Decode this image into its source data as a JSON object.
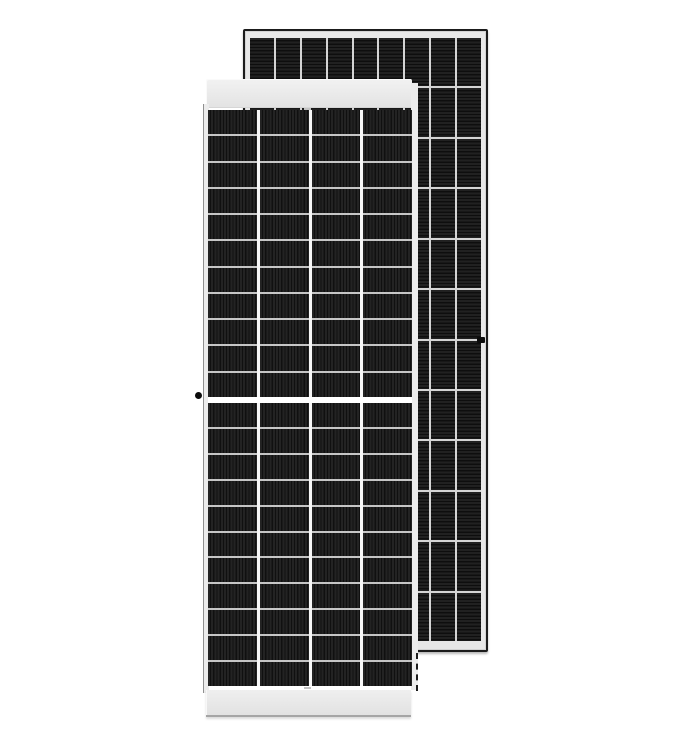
{
  "scene": {
    "type": "product-photo",
    "subject": "Two monocrystalline solar panels: front-view half-cut-cell module overlapping a rear-view module standing behind it",
    "background": "#ffffff"
  },
  "colors": {
    "page_bg": "#ffffff",
    "back_border": "#1b1b1b",
    "back_frame": "#e7e7e7",
    "back_sep": "#d4d4d4",
    "back_cell_a": "#212121",
    "back_cell_b": "#0e0e0e",
    "front_band_top": "#f2f2f2",
    "front_band_bottom": "#e3e3e3",
    "front_frame": "#ececec",
    "front_edge": "#8f8f8f",
    "front_col_sep": "#f7f7f7",
    "front_row_sep": "#c6c6c6",
    "front_cell_a": "#232323",
    "front_cell_b": "#101010",
    "band_edge": "#a5a5a5",
    "dot": "#0b0b0b"
  },
  "panels": {
    "front": {
      "label": "front solar panel, front face with half-cut cells and center split",
      "columns": 4,
      "rows_upper": 11,
      "rows_lower": 11,
      "cell_texture": "vertical-stripes",
      "has_center_split": true,
      "mount_dot_side": "left"
    },
    "back": {
      "label": "rear solar panel, back face with horizontal cell striping",
      "columns": 9,
      "rows": 12,
      "cell_texture": "horizontal-stripes",
      "mount_dot_side": "right"
    }
  }
}
